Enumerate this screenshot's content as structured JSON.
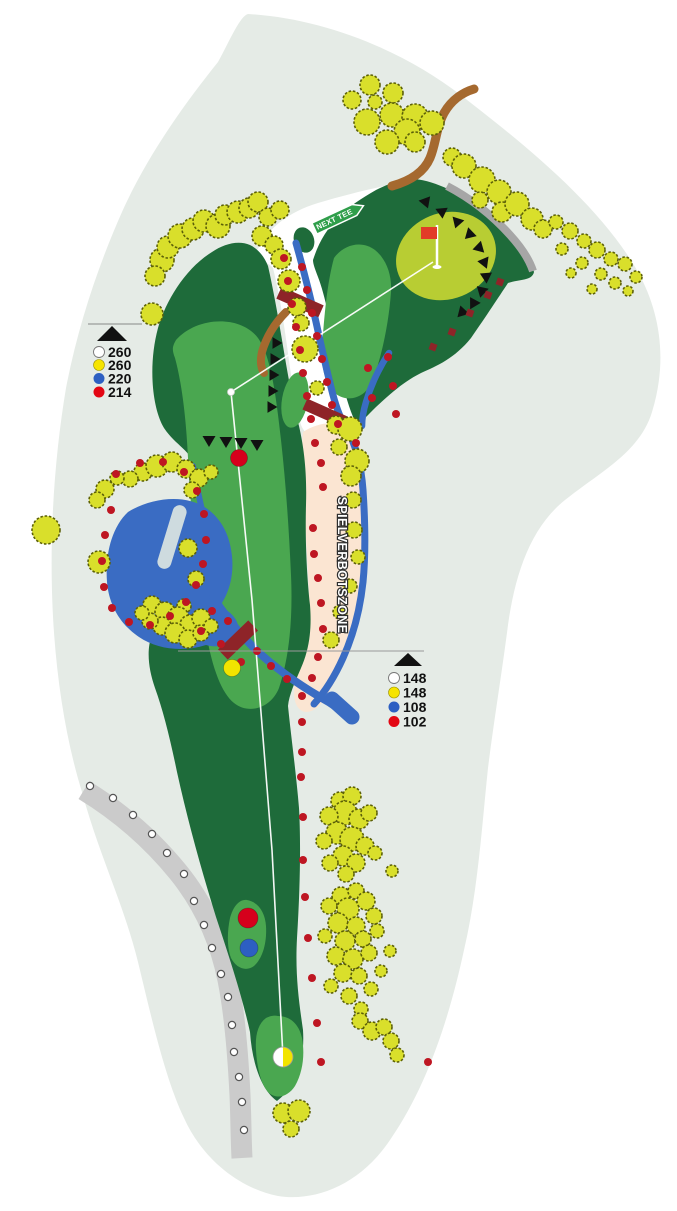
{
  "labels": {
    "no_play_zone": "SPIELVERBOTSZONE",
    "next_tee_sign": "NEXT TEE"
  },
  "legends": {
    "top": {
      "items": [
        {
          "name": "white-tee",
          "hex": "#ffffff",
          "value": "260"
        },
        {
          "name": "yellow-tee",
          "hex": "#f6e400",
          "value": "260"
        },
        {
          "name": "blue-tee",
          "hex": "#2d5fc2",
          "value": "220"
        },
        {
          "name": "red-tee",
          "hex": "#e30613",
          "value": "214"
        }
      ]
    },
    "bottom": {
      "items": [
        {
          "name": "white-tee",
          "hex": "#ffffff",
          "value": "148"
        },
        {
          "name": "yellow-tee",
          "hex": "#f6e400",
          "value": "148"
        },
        {
          "name": "blue-tee",
          "hex": "#2d5fc2",
          "value": "108"
        },
        {
          "name": "red-tee",
          "hex": "#e30613",
          "value": "102"
        }
      ]
    }
  },
  "colors": {
    "background": "#ffffff",
    "rough_blob": "#e5ebe6",
    "fairway": "#1e6b3a",
    "semi_rough": "#4aa750",
    "putting_green": "#b8cd33",
    "water": "#3a6cc3",
    "no_play_zone": "#fbe5d2",
    "cart_path": "#cbcbcb",
    "back_path": "#a6a6a6",
    "tree_fill": "#d9df2b",
    "tree_outline": "#5c6008",
    "hazard_dot": "#be1622",
    "bridge": "#8e2428",
    "dirt_path": "#a5692f",
    "sign_green": "#2f9e4a",
    "flag_red": "#e23b28",
    "play_line": "#ffffff"
  },
  "map": {
    "play_line": [
      [
        283,
        1057
      ],
      [
        272,
        850
      ],
      [
        252,
        600
      ],
      [
        231,
        392
      ],
      [
        433,
        262
      ]
    ],
    "dogleg_point": {
      "x": 231,
      "y": 392
    },
    "flag": {
      "pole_x": 437,
      "top_y": 225,
      "base_y": 267
    },
    "green_center": {
      "x": 446,
      "y": 257
    },
    "fairway_markers": [
      {
        "name": "red-distance-marker",
        "x": 239,
        "y": 458,
        "r": 8.5,
        "hex": "#d6001c"
      },
      {
        "name": "yellow-distance-marker",
        "x": 232,
        "y": 668,
        "r": 8.5,
        "hex": "#f2e400"
      },
      {
        "name": "red-tee-spot",
        "x": 248,
        "y": 918,
        "r": 10,
        "hex": "#d6001c"
      },
      {
        "name": "blue-tee-spot",
        "x": 249,
        "y": 948,
        "r": 9,
        "hex": "#2d5fc2"
      }
    ],
    "split_tee_marker": {
      "x": 283,
      "y": 1057,
      "r": 10,
      "left_hex": "#ffffff",
      "right_hex": "#f2e400"
    },
    "trees": [
      [
        370,
        85,
        10
      ],
      [
        352,
        100,
        9
      ],
      [
        393,
        93,
        10
      ],
      [
        375,
        102,
        7
      ],
      [
        392,
        115,
        12
      ],
      [
        367,
        122,
        13
      ],
      [
        415,
        117,
        13
      ],
      [
        432,
        123,
        12
      ],
      [
        407,
        132,
        13
      ],
      [
        387,
        142,
        12
      ],
      [
        415,
        142,
        10
      ],
      [
        452,
        157,
        9
      ],
      [
        464,
        166,
        12
      ],
      [
        482,
        180,
        13
      ],
      [
        499,
        192,
        12
      ],
      [
        502,
        212,
        10
      ],
      [
        517,
        204,
        12
      ],
      [
        532,
        219,
        11
      ],
      [
        543,
        229,
        9
      ],
      [
        480,
        200,
        8
      ],
      [
        556,
        222,
        7
      ],
      [
        570,
        231,
        8
      ],
      [
        584,
        241,
        7
      ],
      [
        562,
        249,
        6
      ],
      [
        597,
        250,
        8
      ],
      [
        611,
        259,
        7
      ],
      [
        582,
        263,
        6
      ],
      [
        625,
        264,
        7
      ],
      [
        601,
        274,
        6
      ],
      [
        615,
        283,
        6
      ],
      [
        636,
        277,
        6
      ],
      [
        592,
        289,
        5
      ],
      [
        571,
        273,
        5
      ],
      [
        628,
        291,
        5
      ],
      [
        152,
        314,
        11
      ],
      [
        162,
        260,
        12
      ],
      [
        155,
        276,
        10
      ],
      [
        168,
        247,
        11
      ],
      [
        180,
        236,
        12
      ],
      [
        193,
        229,
        11
      ],
      [
        204,
        221,
        11
      ],
      [
        218,
        226,
        12
      ],
      [
        225,
        215,
        10
      ],
      [
        238,
        212,
        11
      ],
      [
        249,
        208,
        10
      ],
      [
        258,
        202,
        10
      ],
      [
        268,
        217,
        9
      ],
      [
        280,
        210,
        9
      ],
      [
        262,
        236,
        10
      ],
      [
        274,
        245,
        9
      ],
      [
        281,
        259,
        10
      ],
      [
        289,
        281,
        11
      ],
      [
        297,
        307,
        9
      ],
      [
        301,
        323,
        8
      ],
      [
        305,
        349,
        13
      ],
      [
        317,
        388,
        7
      ],
      [
        336,
        425,
        9
      ],
      [
        350,
        429,
        12
      ],
      [
        339,
        447,
        8
      ],
      [
        357,
        461,
        12
      ],
      [
        351,
        476,
        10
      ],
      [
        353,
        500,
        8
      ],
      [
        354,
        530,
        8
      ],
      [
        358,
        557,
        7
      ],
      [
        350,
        586,
        7
      ],
      [
        340,
        612,
        7
      ],
      [
        331,
        640,
        8
      ],
      [
        184,
        606,
        7
      ],
      [
        143,
        472,
        9
      ],
      [
        157,
        466,
        11
      ],
      [
        172,
        462,
        10
      ],
      [
        186,
        469,
        9
      ],
      [
        199,
        478,
        9
      ],
      [
        211,
        472,
        7
      ],
      [
        130,
        479,
        8
      ],
      [
        117,
        478,
        7
      ],
      [
        105,
        489,
        9
      ],
      [
        97,
        500,
        8
      ],
      [
        192,
        490,
        8
      ],
      [
        188,
        548,
        9
      ],
      [
        196,
        579,
        8
      ],
      [
        152,
        605,
        9
      ],
      [
        165,
        612,
        10
      ],
      [
        178,
        618,
        11
      ],
      [
        190,
        625,
        10
      ],
      [
        201,
        618,
        9
      ],
      [
        162,
        626,
        9
      ],
      [
        175,
        633,
        10
      ],
      [
        188,
        639,
        9
      ],
      [
        150,
        621,
        8
      ],
      [
        201,
        633,
        8
      ],
      [
        211,
        626,
        7
      ],
      [
        142,
        613,
        7
      ],
      [
        46,
        530,
        14
      ],
      [
        99,
        562,
        11
      ],
      [
        340,
        801,
        9
      ],
      [
        352,
        796,
        9
      ],
      [
        345,
        813,
        12
      ],
      [
        329,
        816,
        9
      ],
      [
        359,
        819,
        10
      ],
      [
        369,
        813,
        8
      ],
      [
        337,
        833,
        11
      ],
      [
        352,
        839,
        12
      ],
      [
        324,
        841,
        8
      ],
      [
        365,
        846,
        9
      ],
      [
        343,
        856,
        10
      ],
      [
        330,
        863,
        8
      ],
      [
        356,
        863,
        9
      ],
      [
        375,
        853,
        7
      ],
      [
        346,
        874,
        8
      ],
      [
        392,
        871,
        6
      ],
      [
        341,
        896,
        9
      ],
      [
        356,
        891,
        8
      ],
      [
        329,
        906,
        8
      ],
      [
        348,
        909,
        11
      ],
      [
        366,
        901,
        9
      ],
      [
        374,
        916,
        8
      ],
      [
        338,
        923,
        10
      ],
      [
        356,
        926,
        9
      ],
      [
        325,
        936,
        7
      ],
      [
        345,
        941,
        10
      ],
      [
        363,
        939,
        8
      ],
      [
        377,
        931,
        7
      ],
      [
        336,
        956,
        9
      ],
      [
        353,
        959,
        10
      ],
      [
        369,
        953,
        8
      ],
      [
        343,
        973,
        9
      ],
      [
        359,
        976,
        8
      ],
      [
        331,
        986,
        7
      ],
      [
        371,
        989,
        7
      ],
      [
        349,
        996,
        8
      ],
      [
        361,
        1009,
        7
      ],
      [
        381,
        971,
        6
      ],
      [
        390,
        951,
        6
      ],
      [
        360,
        1021,
        8
      ],
      [
        372,
        1031,
        9
      ],
      [
        384,
        1027,
        8
      ],
      [
        391,
        1041,
        8
      ],
      [
        397,
        1055,
        7
      ],
      [
        283,
        1113,
        10
      ],
      [
        299,
        1111,
        11
      ],
      [
        291,
        1129,
        8
      ]
    ],
    "hazard_dots": [
      [
        284,
        258
      ],
      [
        288,
        281
      ],
      [
        292,
        304
      ],
      [
        296,
        327
      ],
      [
        300,
        350
      ],
      [
        303,
        373
      ],
      [
        307,
        396
      ],
      [
        311,
        419
      ],
      [
        302,
        267
      ],
      [
        307,
        290
      ],
      [
        312,
        313
      ],
      [
        317,
        336
      ],
      [
        322,
        359
      ],
      [
        327,
        382
      ],
      [
        332,
        405
      ],
      [
        338,
        424
      ],
      [
        388,
        357
      ],
      [
        368,
        368
      ],
      [
        393,
        386
      ],
      [
        372,
        398
      ],
      [
        396,
        414
      ],
      [
        356,
        443
      ],
      [
        315,
        443
      ],
      [
        321,
        463
      ],
      [
        323,
        487
      ],
      [
        313,
        528
      ],
      [
        314,
        554
      ],
      [
        318,
        578
      ],
      [
        321,
        603
      ],
      [
        323,
        629
      ],
      [
        318,
        657
      ],
      [
        312,
        678
      ],
      [
        212,
        611
      ],
      [
        201,
        631
      ],
      [
        228,
        621
      ],
      [
        221,
        644
      ],
      [
        241,
        662
      ],
      [
        257,
        651
      ],
      [
        271,
        666
      ],
      [
        287,
        679
      ],
      [
        302,
        696
      ],
      [
        302,
        722
      ],
      [
        302,
        752
      ],
      [
        301,
        777
      ],
      [
        303,
        817
      ],
      [
        303,
        860
      ],
      [
        305,
        897
      ],
      [
        308,
        938
      ],
      [
        312,
        978
      ],
      [
        317,
        1023
      ],
      [
        321,
        1062
      ],
      [
        428,
        1062
      ],
      [
        116,
        474
      ],
      [
        140,
        463
      ],
      [
        163,
        462
      ],
      [
        184,
        472
      ],
      [
        197,
        491
      ],
      [
        204,
        514
      ],
      [
        206,
        540
      ],
      [
        203,
        564
      ],
      [
        196,
        585
      ],
      [
        186,
        602
      ],
      [
        170,
        616
      ],
      [
        150,
        625
      ],
      [
        129,
        622
      ],
      [
        112,
        608
      ],
      [
        104,
        587
      ],
      [
        102,
        561
      ],
      [
        105,
        535
      ],
      [
        111,
        510
      ]
    ],
    "ob_stakes": [
      [
        90,
        786
      ],
      [
        113,
        798
      ],
      [
        133,
        815
      ],
      [
        152,
        834
      ],
      [
        167,
        853
      ],
      [
        184,
        874
      ],
      [
        194,
        901
      ],
      [
        204,
        925
      ],
      [
        212,
        948
      ],
      [
        221,
        974
      ],
      [
        228,
        997
      ],
      [
        232,
        1025
      ],
      [
        234,
        1052
      ],
      [
        239,
        1077
      ],
      [
        242,
        1102
      ],
      [
        244,
        1130
      ]
    ],
    "fairway_triangles": [
      [
        209,
        441
      ],
      [
        226,
        442
      ],
      [
        241,
        443
      ],
      [
        257,
        445
      ]
    ],
    "corridor_triangles": [
      [
        277,
        343
      ],
      [
        275,
        359
      ],
      [
        274,
        375
      ],
      [
        273,
        391
      ],
      [
        272,
        407
      ]
    ],
    "green_triangles": [
      [
        426,
        203
      ],
      [
        442,
        213
      ],
      [
        457,
        223
      ],
      [
        469,
        235
      ],
      [
        478,
        248
      ],
      [
        483,
        262
      ],
      [
        485,
        276
      ],
      [
        481,
        290
      ],
      [
        473,
        302
      ],
      [
        462,
        311
      ]
    ],
    "maroon_squares": [
      [
        500,
        282
      ],
      [
        488,
        295
      ],
      [
        470,
        313
      ],
      [
        452,
        332
      ],
      [
        433,
        347
      ]
    ]
  }
}
